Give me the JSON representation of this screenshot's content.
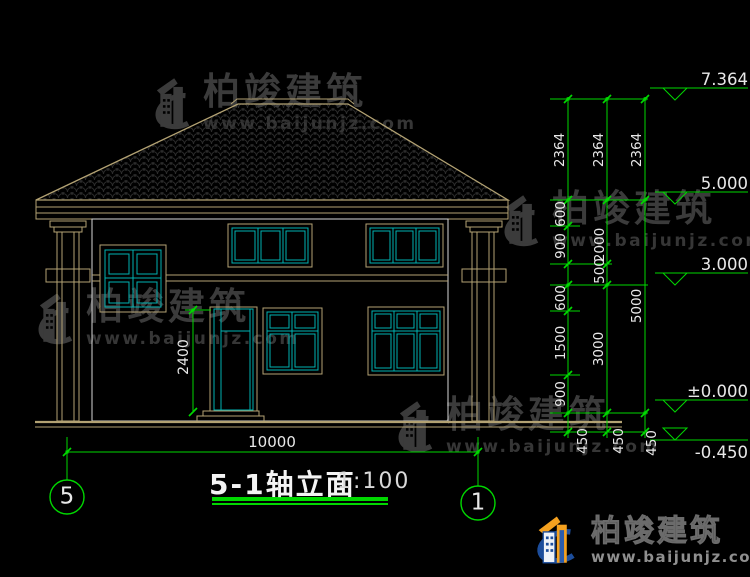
{
  "drawing": {
    "title": "5-1轴立面",
    "scale_label": "1:100",
    "grid_bubble_left": "5",
    "grid_bubble_right": "1",
    "overall_width": "10000",
    "door_height": "2400",
    "elevation_marks": [
      "7.364",
      "5.000",
      "3.000",
      "±0.000",
      "-0.450"
    ],
    "dim_chain_inner": [
      "2364",
      "600",
      "900",
      "500",
      "600",
      "1500",
      "900",
      "450"
    ],
    "dim_chain_middle": [
      "2364",
      "2000",
      "3000",
      "450"
    ],
    "dim_chain_outer": [
      "2364",
      "5000",
      "450"
    ]
  },
  "watermark": {
    "brand": "柏竣建筑",
    "url": "www.baijunjz.com"
  },
  "footer_logo": {
    "brand": "柏竣建筑",
    "url": "www.baijunjz.com"
  },
  "colors": {
    "cad_tan": "#b3a273",
    "cad_cyan": "#00b2b2",
    "cad_green": "#00d800",
    "cad_white": "#d9d9d9",
    "brand_blue": "#1c4d9b",
    "brand_orange": "#f5a11f"
  }
}
